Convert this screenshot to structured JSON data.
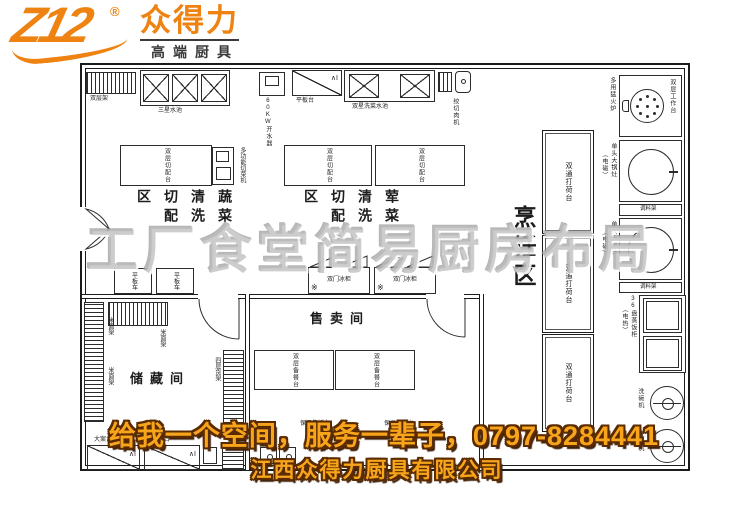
{
  "logo": {
    "mark": "Z12",
    "registered": "®",
    "brand": "众得力",
    "tagline": "高端厨具",
    "brand_color": "#ee8311"
  },
  "watermark": {
    "text": "工厂食堂简易厨房布局",
    "color": "#bebebe"
  },
  "banner": {
    "line1": "给我一个空间，服务一辈子，0797-8284441",
    "line2": "江西众得力厨具有限公司",
    "fill_color": "#f9a51c",
    "outline_color": "#5a2b00"
  },
  "zones": {
    "cooking": "烹饪区",
    "veg_wash": "蔬菜清洗切配区",
    "meat_wash": "荤菜清洗切配区",
    "sale_room": "售卖间",
    "storage_room": "储藏间"
  },
  "equipment": {
    "double_rack": "双层架",
    "three_star_sink": "三星水池",
    "water_boiler": "60KW开水器",
    "flat_table": "平板台",
    "double_star_sink": "双星洗菜水池",
    "meat_cutter": "绞切肉机",
    "multi_stove": "多用猛火炉",
    "double_worktop": "双层工作台",
    "pot_stove": "单头大锅灶",
    "pot_stove_sub": "（电磁）",
    "spice_rack": "调料架",
    "steam_cabinet": "36盘蒸饭柜",
    "steam_cabinet_sub": "（电热）",
    "dishwasher": "洗碗机",
    "pass_table": "双通打荷台",
    "cut_table": "双层切配台",
    "veg_machine": "多功能切菜机",
    "fridge": "双门冰柜",
    "snowflake_icon": "※",
    "cart": "平板车",
    "serve_table": "双层备餐台",
    "warm_table": "保温售饭台",
    "rice_rack": "米面架",
    "four_shelf": "四层货架",
    "board_table": "大案台",
    "break_mark": "∧I"
  }
}
